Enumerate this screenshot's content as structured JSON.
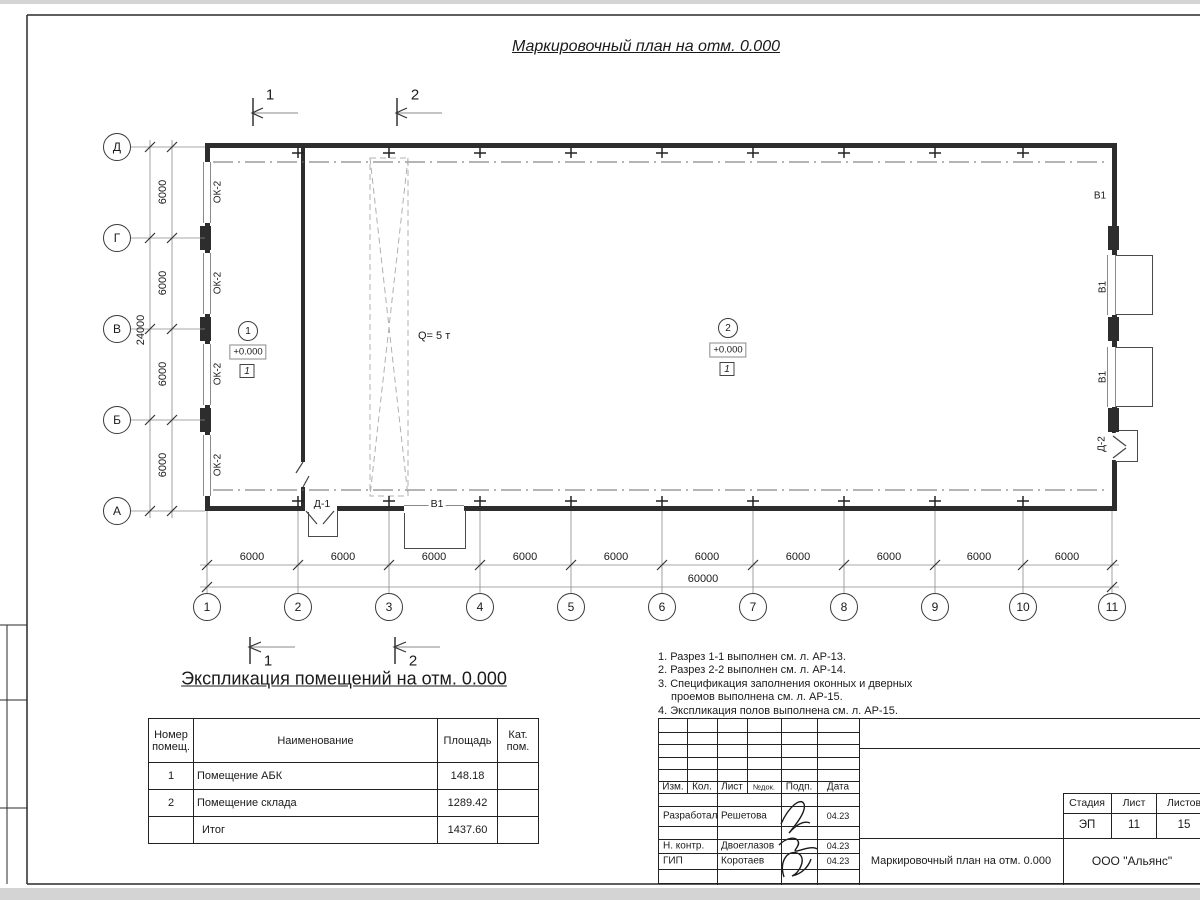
{
  "sheet": {
    "title": "Маркировочный план на отм. 0.000"
  },
  "plan": {
    "sections_top": [
      "1",
      "2"
    ],
    "sections_bottom": [
      "1",
      "2"
    ],
    "grid_cols": [
      "1",
      "2",
      "3",
      "4",
      "5",
      "6",
      "7",
      "8",
      "9",
      "10",
      "11"
    ],
    "grid_rows": [
      "Д",
      "Г",
      "В",
      "Б",
      "А"
    ],
    "bay_dims": [
      "6000",
      "6000",
      "6000",
      "6000",
      "6000",
      "6000",
      "6000",
      "6000",
      "6000",
      "6000"
    ],
    "total_width": "60000",
    "row_dims": [
      "6000",
      "6000",
      "6000",
      "6000"
    ],
    "total_height": "24000",
    "window_labels": [
      "ОК-2",
      "ОК-2",
      "ОК-2",
      "ОК-2"
    ],
    "right_gate_labels": [
      "В1",
      "В1",
      "В1"
    ],
    "bottom_gate_label": "В1",
    "door1_label": "Д-1",
    "door2_label": "Д-2",
    "crane_label": "Q= 5 т",
    "rooms": [
      {
        "num": "1",
        "elev": "+0.000",
        "floor": "1"
      },
      {
        "num": "2",
        "elev": "+0.000",
        "floor": "1"
      }
    ]
  },
  "schedule": {
    "heading": "Экспликация помещений на отм. 0.000",
    "col_headers": [
      "Номер помещ.",
      "Наименование",
      "Площадь",
      "Кат. пом."
    ],
    "rows": [
      {
        "num": "1",
        "name": "Помещение АБК",
        "area": "148.18",
        "cat": ""
      },
      {
        "num": "2",
        "name": "Помещение склада",
        "area": "1289.42",
        "cat": ""
      },
      {
        "num": "",
        "name": "Итог",
        "area": "1437.60",
        "cat": ""
      }
    ]
  },
  "notes": {
    "lines": [
      "1. Разрез 1-1 выполнен см. л. АР-13.",
      "2. Разрез 2-2 выполнен см. л. АР-14.",
      "3. Спецификация заполнения оконных и дверных",
      "проемов выполнена см. л. АР-15.",
      "4. Экспликация полов выполнена см. л. АР-15."
    ]
  },
  "titleblock": {
    "cols": [
      "Изм.",
      "Кол.",
      "Лист",
      "№док.",
      "Подп.",
      "Дата"
    ],
    "rows": [
      {
        "role": "Разработал",
        "name": "Решетова",
        "date": "04.23"
      },
      {
        "role": "Н. контр.",
        "name": "Двоеглазов",
        "date": "04.23"
      },
      {
        "role": "ГИП",
        "name": "Коротаев",
        "date": "04.23"
      }
    ],
    "stage_label": "Стадия",
    "sheet_label": "Лист",
    "sheets_label": "Листов",
    "stage": "ЭП",
    "sheet_no": "11",
    "sheets_total": "15",
    "doc_title": "Маркировочный план на отм. 0.000",
    "company": "ООО \"Альянс\""
  }
}
